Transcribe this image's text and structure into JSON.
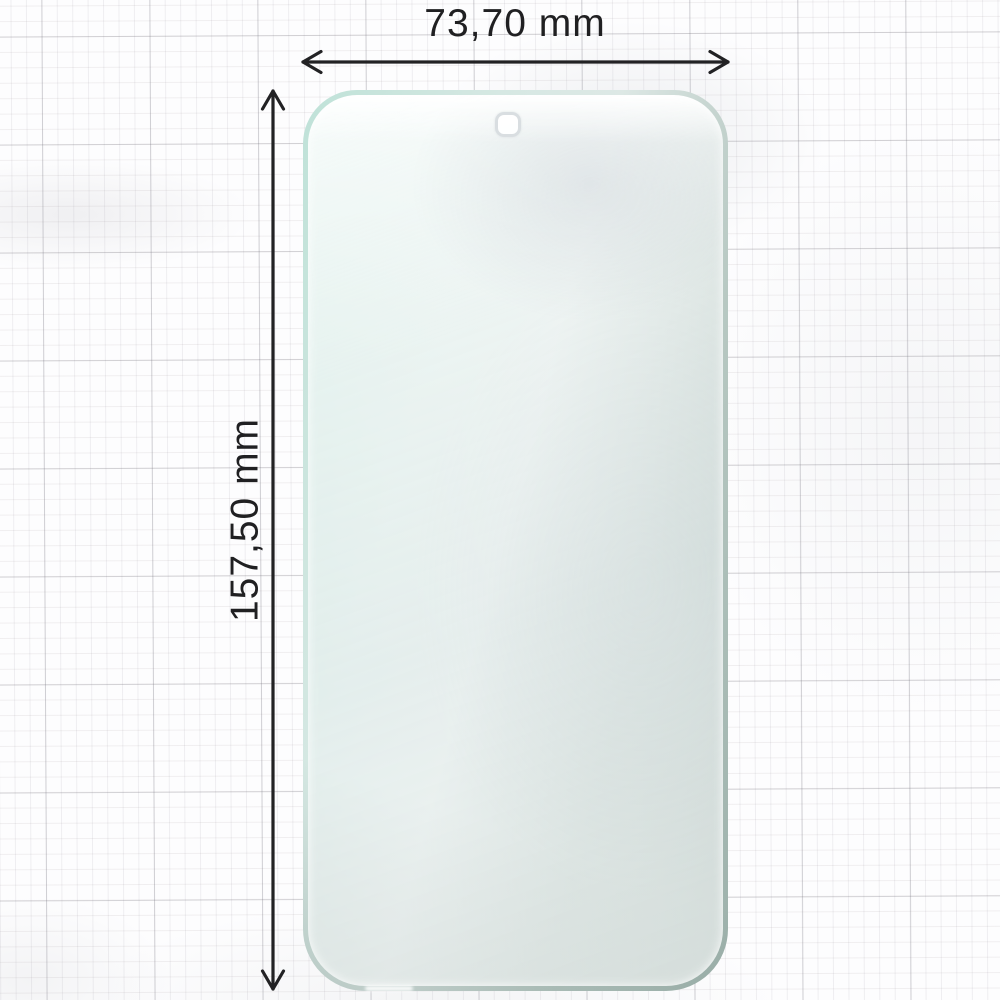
{
  "diagram": {
    "type": "product dimension diagram",
    "subject": "smartphone screen protector film on graph paper",
    "width": {
      "label": "73,70 mm"
    },
    "height": {
      "label": "157,50 mm"
    }
  },
  "film": {
    "camera_cutout": "punch-hole camera cutout near top center",
    "edge_colors": {
      "mint": "#c0e3d9",
      "gray_green": "#9cb0aa"
    }
  },
  "annotation": {
    "ink_color": "#222224",
    "width_arrow": "double-headed-horizontal-arrow",
    "height_arrow": "double-headed-vertical-arrow"
  },
  "paper": {
    "background": "#fcfcfd",
    "grid_minor_color": "#ededf0",
    "grid_major_color": "#d2d2d6"
  }
}
